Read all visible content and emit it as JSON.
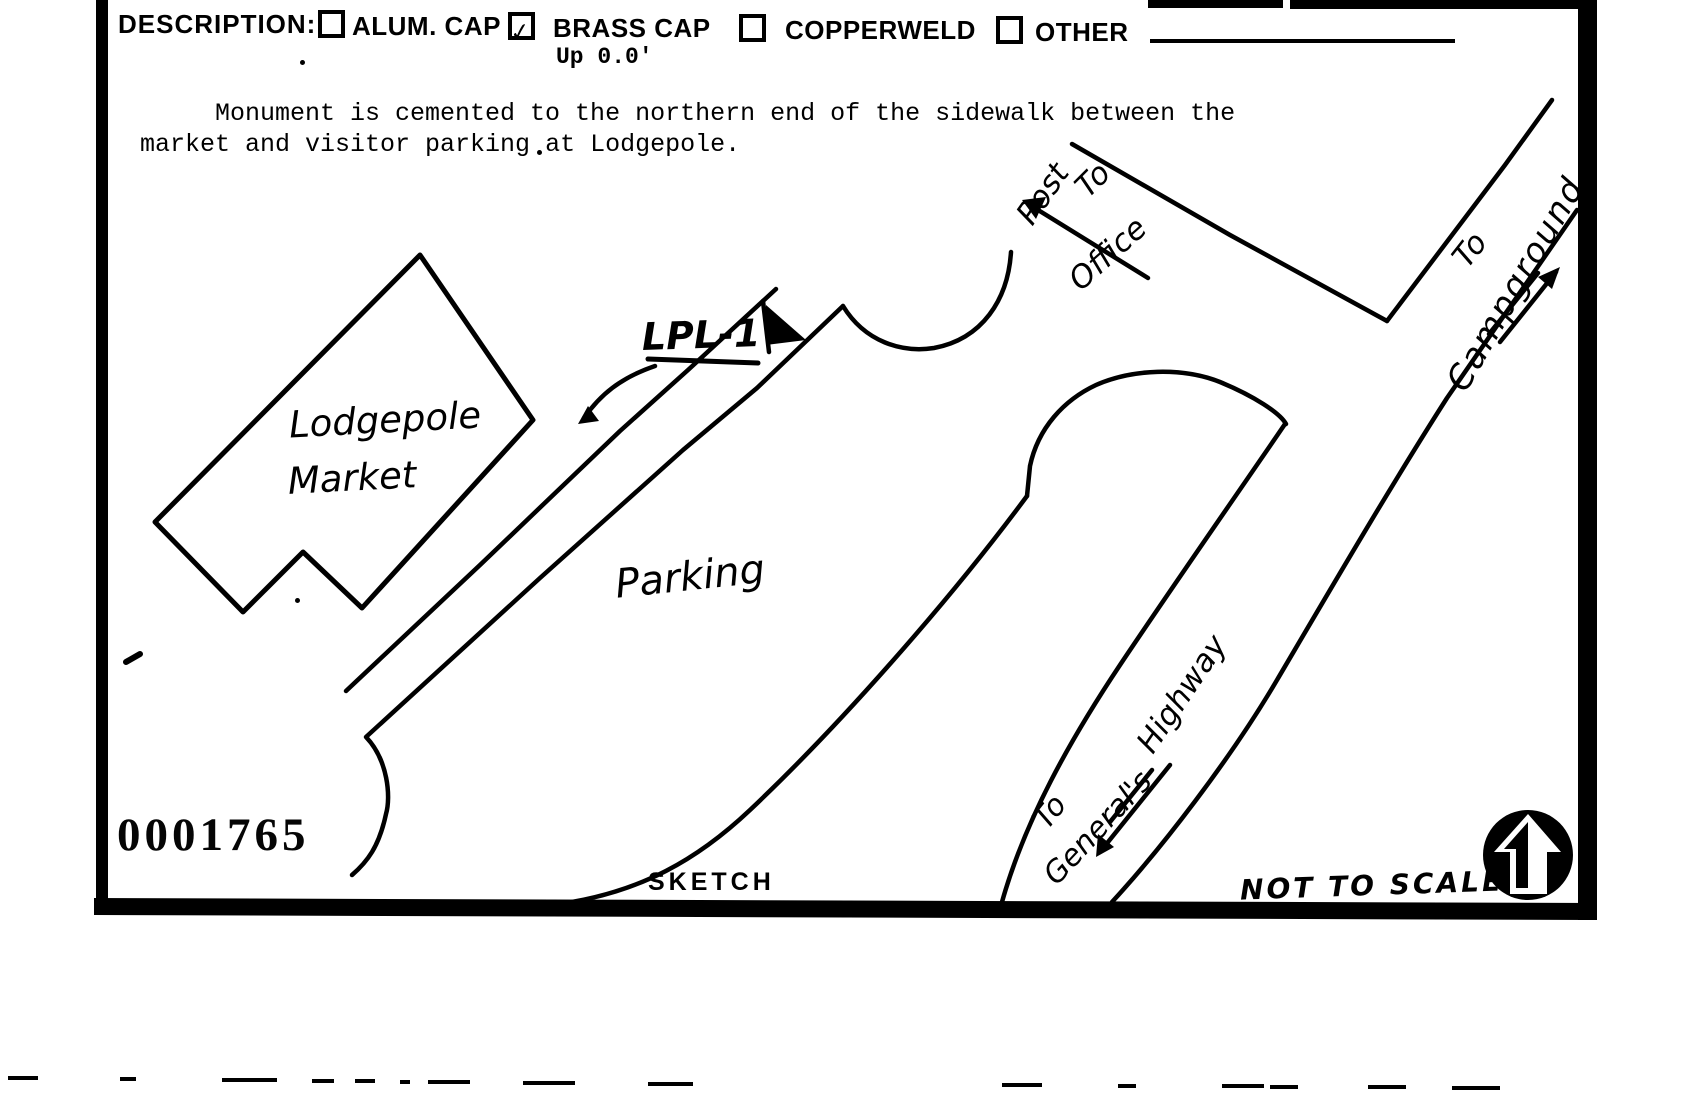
{
  "form": {
    "description_label": "DESCRIPTION:",
    "checkmark": "✓",
    "options": [
      {
        "label": "ALUM. CAP",
        "checked": false
      },
      {
        "label": "BRASS CAP",
        "checked": true,
        "note": "Up 0.0'"
      },
      {
        "label": "COPPERWELD",
        "checked": false
      },
      {
        "label": "OTHER",
        "checked": false,
        "has_blank_line": true
      }
    ]
  },
  "description_text": {
    "line1": "Monument is cemented to the northern end of the sidewalk between the",
    "line2": "market and visitor parking at Lodgepole."
  },
  "sketch": {
    "building_label_line1": "Lodgepole",
    "building_label_line2": "Market",
    "monument_label": "LPL-1",
    "parking_label": "Parking",
    "post_office": {
      "to": "To",
      "post": "Post",
      "office": "Office"
    },
    "campground": {
      "to": "To",
      "name": "Campground"
    },
    "generals_highway": {
      "to": "To",
      "name_part1": "General's",
      "name_part2": "Highway"
    },
    "sketch_caption": "SKETCH",
    "scale_note": "NOT TO SCALE",
    "stamp_number": "0001765",
    "ink_color": "#000000",
    "paper_color": "#ffffff"
  }
}
